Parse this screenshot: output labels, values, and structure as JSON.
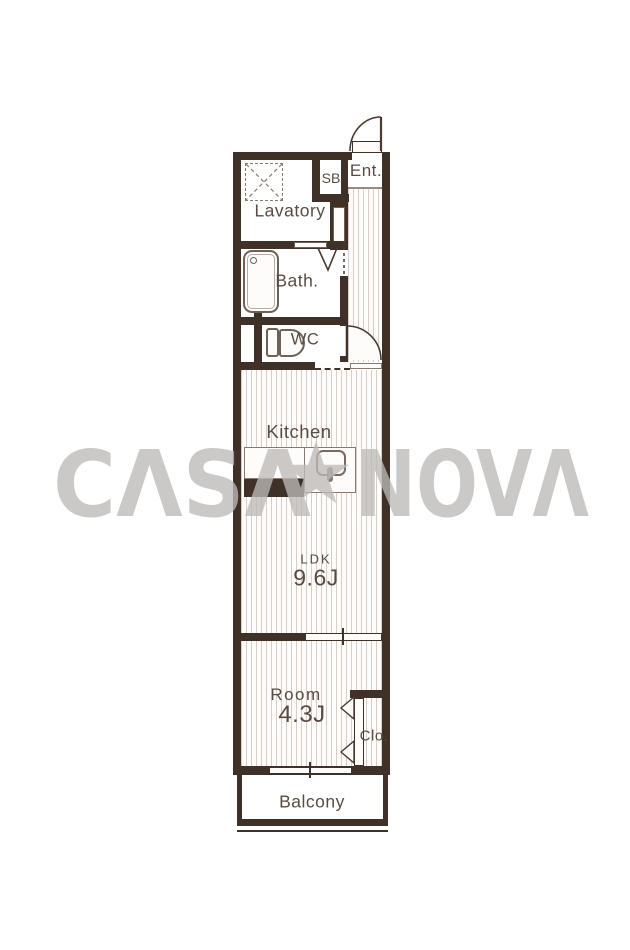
{
  "watermark": {
    "text_left": "CΛSΛ",
    "star": "★",
    "text_right": "NOVΛ",
    "color": "#bdbab8"
  },
  "plan": {
    "rooms": [
      {
        "label": "Ent."
      },
      {
        "label": "SB"
      },
      {
        "label": "Lavatory"
      },
      {
        "label": "Bath."
      },
      {
        "label": "WC"
      },
      {
        "label": "Kitchen"
      },
      {
        "label": "LDK",
        "size": "9.6J"
      },
      {
        "label": "Room",
        "size": "4.3J"
      },
      {
        "label": "Clo."
      },
      {
        "label": "Balcony"
      }
    ],
    "colors": {
      "wall": "#3f3028",
      "label_text": "#5a4b42",
      "hatch_line": "#d8cec6",
      "fixture_line": "#6f6056",
      "watermark": "#bdbab8"
    }
  }
}
